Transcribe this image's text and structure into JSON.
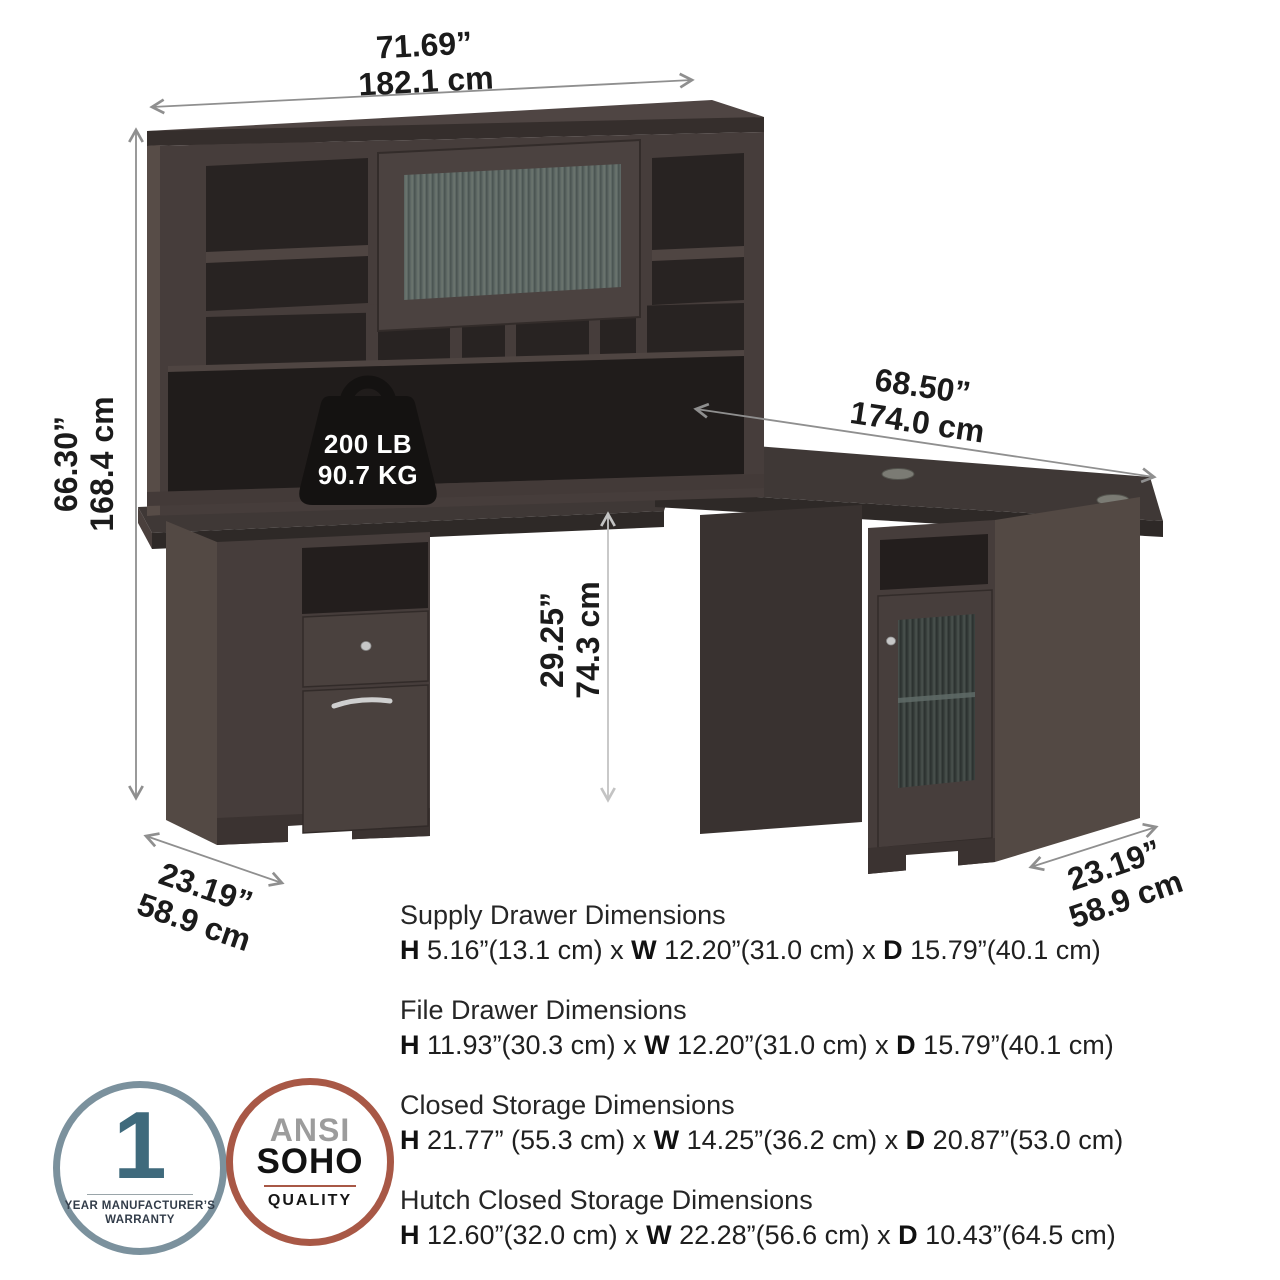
{
  "dimensions": {
    "hutch_width": {
      "inches": "71.69”",
      "cm": "182.1 cm"
    },
    "overall_height": {
      "inches": "66.30”",
      "cm": "168.4 cm"
    },
    "return_width": {
      "inches": "68.50”",
      "cm": "174.0 cm"
    },
    "desk_height": {
      "inches": "29.25”",
      "cm": "74.3 cm"
    },
    "left_depth": {
      "inches": "23.19”",
      "cm": "58.9 cm"
    },
    "right_depth": {
      "inches": "23.19”",
      "cm": "58.9 cm"
    }
  },
  "weight_capacity": {
    "pounds": "200 LB",
    "kilograms": "90.7 KG"
  },
  "specs": [
    {
      "title": "Supply Drawer Dimensions",
      "h_label": "H",
      "h_value": " 5.16”(13.1 cm) x ",
      "w_label": "W",
      "w_value": " 12.20”(31.0 cm) x ",
      "d_label": "D",
      "d_value": " 15.79”(40.1 cm)"
    },
    {
      "title": "File Drawer Dimensions",
      "h_label": "H",
      "h_value": " 11.93”(30.3 cm) x ",
      "w_label": "W",
      "w_value": " 12.20”(31.0 cm) x ",
      "d_label": "D",
      "d_value": " 15.79”(40.1 cm)"
    },
    {
      "title": "Closed Storage Dimensions",
      "h_label": "H",
      "h_value": " 21.77” (55.3 cm) x ",
      "w_label": "W",
      "w_value": " 14.25”(36.2 cm) x ",
      "d_label": "D",
      "d_value": " 20.87”(53.0 cm)"
    },
    {
      "title": "Hutch Closed Storage Dimensions",
      "h_label": "H",
      "h_value": " 12.60”(32.0 cm) x ",
      "w_label": "W",
      "w_value": " 22.28”(56.6 cm) x ",
      "d_label": "D",
      "d_value": " 10.43”(64.5 cm)"
    }
  ],
  "badges": {
    "warranty": {
      "number": "1",
      "line1": "YEAR MANUFACTURER’S",
      "line2": "WARRANTY"
    },
    "ansi": {
      "line1": "ANSI",
      "line2": "SOHO",
      "line3": "QUALITY"
    }
  },
  "colors": {
    "wood_front": "#463d3b",
    "wood_top": "#3f3836",
    "wood_side": "#534944",
    "wood_dark_opening": "#231e1d",
    "glass": "#5d6764",
    "arrow": "#8f8f8f",
    "warranty_ring": "#7b919d",
    "warranty_number": "#3f6a7c",
    "ansi_ring": "#a85846",
    "text": "#1c1c1c"
  }
}
